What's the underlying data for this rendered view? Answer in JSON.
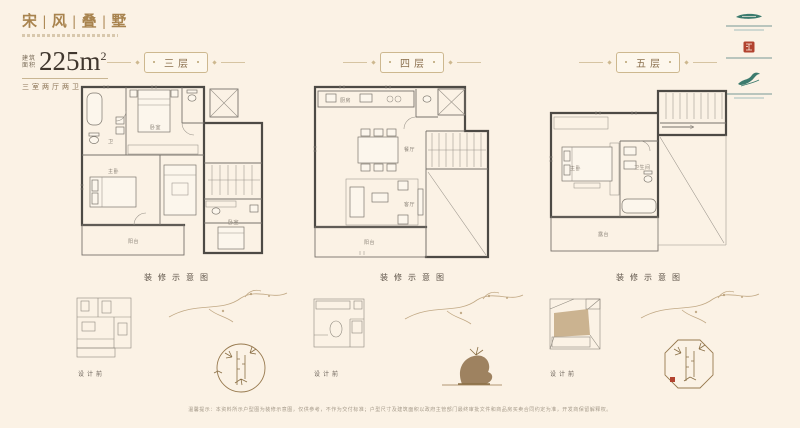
{
  "brand": {
    "title": "宋 | 风 | 叠 | 墅",
    "area_label_1": "建筑",
    "area_label_2": "面积",
    "area_value": "225m",
    "area_sup": "2",
    "spec": "三室两厅两卫"
  },
  "logos": [
    {
      "icon": "ribbon-mark",
      "color": "#3c7b6e"
    },
    {
      "icon": "red-seal-mark",
      "color": "#b2432f"
    },
    {
      "icon": "crane-mark",
      "color": "#3c7b6e"
    }
  ],
  "panels": [
    {
      "floor_label": "三层",
      "caption": "装修示意图",
      "mini_label": "设计前",
      "rooms": {
        "r1": "卧室",
        "r2": "主卧",
        "r3": "卧室",
        "r4": "阳台",
        "r5": "卫"
      }
    },
    {
      "floor_label": "四层",
      "caption": "装修示意图",
      "mini_label": "设计前",
      "rooms": {
        "r1": "厨房",
        "r2": "餐厅",
        "r3": "客厅",
        "r4": "阳台"
      }
    },
    {
      "floor_label": "五层",
      "caption": "装修示意图",
      "mini_label": "设计前",
      "rooms": {
        "r1": "主卧",
        "r2": "卫生间",
        "r3": "露台"
      }
    }
  ],
  "footer": {
    "disclaimer": "温馨提示：本资料所示户型图为装修示意图，仅供参考，不作为交付标准；户型尺寸及建筑面积以政府主管部门最终审批文件和商品房买卖合同约定为准，开发商保留解释权。"
  }
}
